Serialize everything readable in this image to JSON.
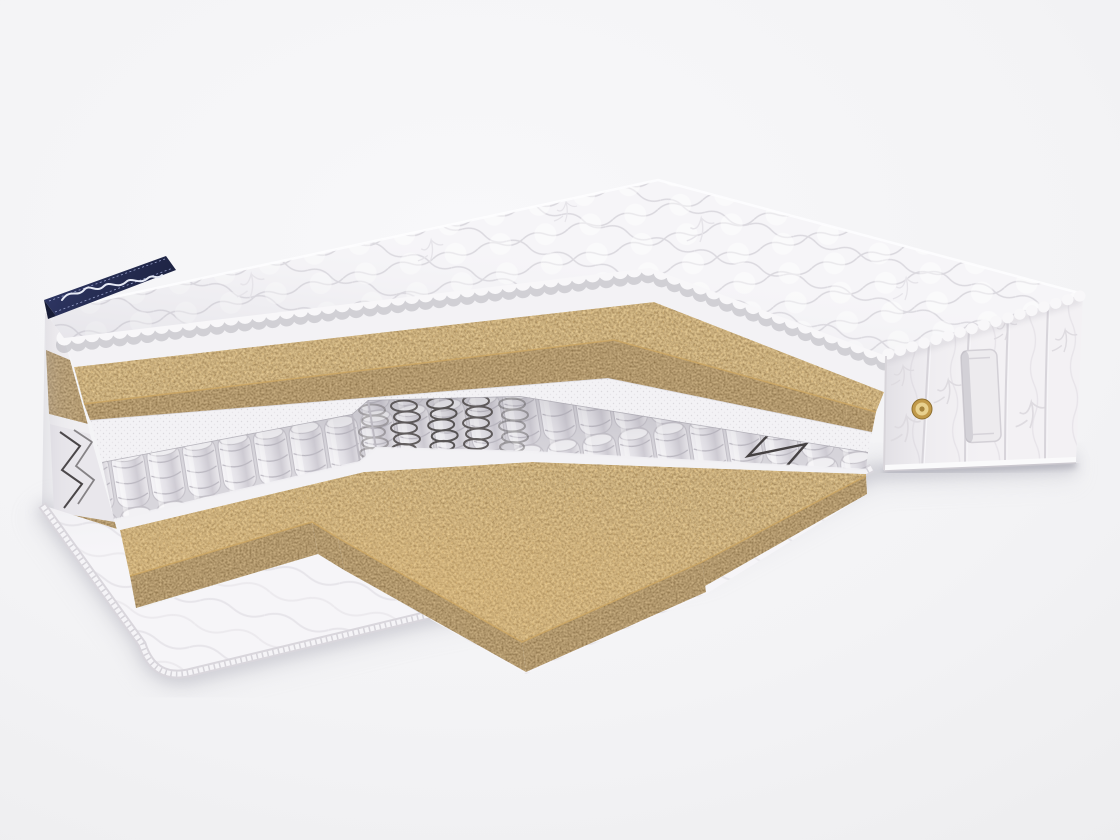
{
  "scene": {
    "description": "Studio product render of a double mattress with a stepped corner cutaway revealing inner layers",
    "background": "#f3f3f5"
  },
  "colors": {
    "quilt_white": "#f6f5f8",
    "quilt_line": "#d9d7dd",
    "coir_brown": "#7c5b31",
    "coir_dark": "#5a3d1f",
    "felt_white": "#f3f2f5",
    "spring_fabric": "#e9e8ec",
    "spring_outline": "#bcb9c1",
    "wire_dark": "#4a4646",
    "side_fabric": "#f3f1f4",
    "seam_gray": "#d7d4da",
    "binding_gray": "#d9d6dc",
    "ribbon_navy": "#272e55",
    "ribbon_navy_light": "#323a6b",
    "ribbon_text": "#e6eaf6",
    "vent_gold": "#c19a4a",
    "vent_gold_light": "#e8d18f",
    "vent_gold_dark": "#8e6f2f",
    "handle_fabric": "#edebee",
    "shadow": "#b6b6c0"
  },
  "parts": {
    "top_cover": "quilted top cover",
    "brand_ribbon": "navy corner ribbon with illegible white cursive signature",
    "top_coir": "coconut coir layer (top)",
    "felt_spacer": "white felt spacer sheet",
    "spring_block": "independent pocket spring unit",
    "bare_springs": "exposed steel coil springs",
    "frame_wire": "steel frame zigzag wire",
    "bottom_coir": "coconut coir layer (bottom)",
    "bottom_cover": "quilted bottom cover with binding tape",
    "side_border": "embroidered side border fabric",
    "air_vent": "gold air vent grommet",
    "handle": "side handle strap"
  }
}
